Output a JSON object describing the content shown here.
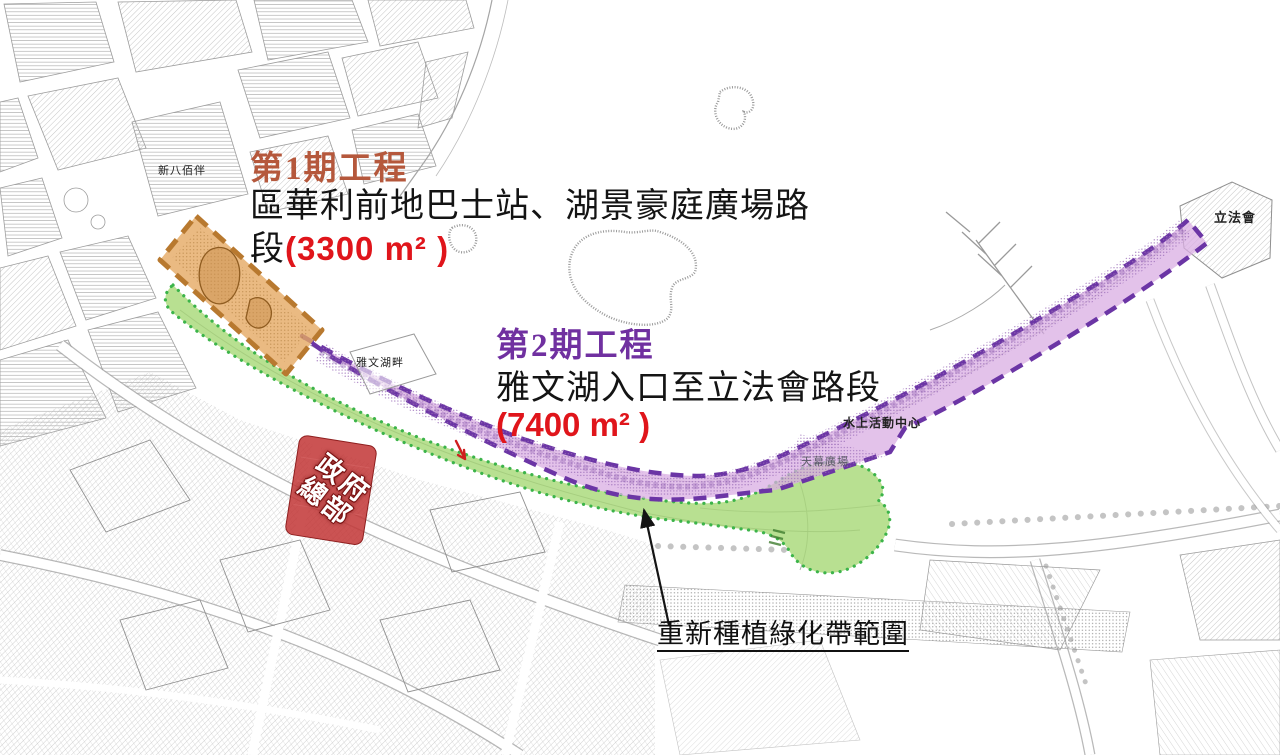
{
  "annotations": {
    "phase1": {
      "title": "第1期工程",
      "desc_line1": "區華利前地巴士站、湖景豪庭廣場路",
      "desc_line2_prefix": "段",
      "area": "(3300 m² )"
    },
    "phase2": {
      "title": "第2期工程",
      "desc": "雅文湖入口至立法會路段",
      "area": "(7400 m² )"
    },
    "replanting_note": {
      "label": "重新種植綠化帶範圍"
    }
  },
  "map_labels": {
    "new_yaohan": "新八佰伴",
    "anim_lago": "雅文湖畔",
    "water_activities_centre": "水上活動中心",
    "canopy_plaza": "天幕廣場",
    "legislative_assembly": "立法會",
    "government_hq_line1": "政府",
    "government_hq_line2": "總部"
  },
  "zones": {
    "phase1": {
      "name": "第1期工程",
      "fill": "#e5a963",
      "border": "#b8792f"
    },
    "phase2": {
      "name": "第2期工程",
      "fill": "#d9aee3",
      "border": "#6b35a5"
    },
    "replanting": {
      "name": "重新種植綠化帶範圍",
      "fill": "#a6d876",
      "border": "#3cb44a"
    },
    "government_hq": {
      "fill": "#c23535"
    }
  },
  "colors": {
    "phase1_title": "#b5583c",
    "phase2_title": "#7030a0",
    "area_text": "#e0151b",
    "annotation_text": "#141414",
    "map_linework": "#a8a8a8"
  }
}
